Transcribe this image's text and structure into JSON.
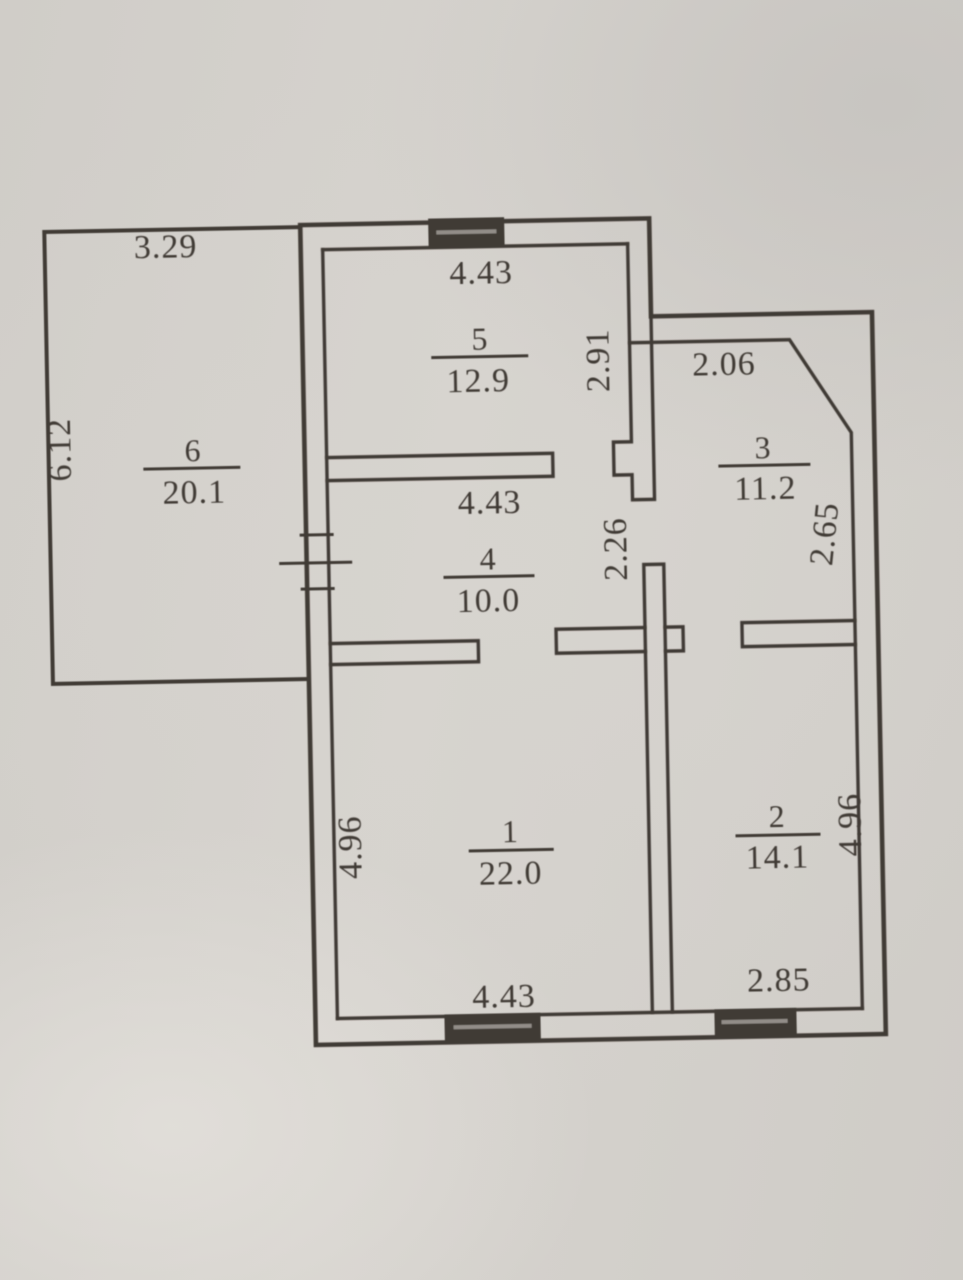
{
  "document": {
    "kind": "apartment-floor-plan-scan",
    "colors": {
      "ink": "#403a35",
      "paper": "#d5d2cd"
    }
  },
  "floor_plan": {
    "rooms": [
      {
        "number": "1",
        "area": "22.0"
      },
      {
        "number": "2",
        "area": "14.1"
      },
      {
        "number": "3",
        "area": "11.2"
      },
      {
        "number": "4",
        "area": "10.0"
      },
      {
        "number": "5",
        "area": "12.9"
      },
      {
        "number": "6",
        "area": "20.1"
      }
    ],
    "dimensions": {
      "room6_top": "3.29",
      "room6_left": "6.12",
      "room5_top": "4.43",
      "room5_right": "2.91",
      "room3_top": "2.06",
      "room3_right": "2.65",
      "room4_top": "4.43",
      "hall_right": "2.26",
      "room1_left": "4.96",
      "room1_bottom": "4.43",
      "room2_right": "4.96",
      "room2_bottom": "2.85"
    }
  }
}
